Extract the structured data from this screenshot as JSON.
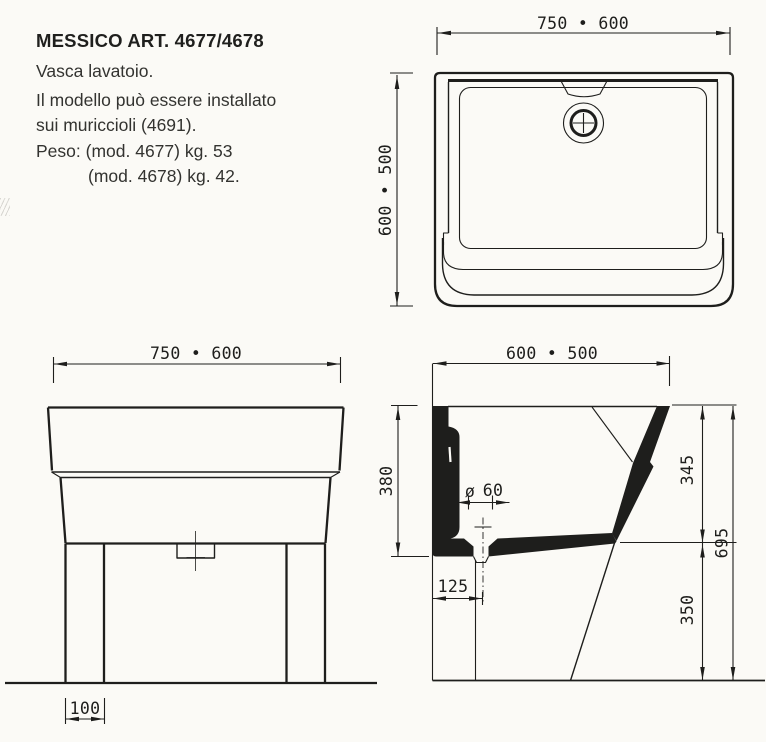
{
  "product": {
    "title": "MESSICO ART. 4677/4678",
    "line1": "Vasca lavatoio.",
    "line2": "Il modello può essere installato",
    "line3": "sui muriccioli (4691).",
    "line4": "Peso: (mod. 4677) kg. 53",
    "line5": "(mod. 4678) kg. 42."
  },
  "dimensions": {
    "top_view": {
      "width": "750 • 600",
      "depth": "600 • 500"
    },
    "front_view": {
      "width": "750 • 600",
      "leg": "100"
    },
    "section_view": {
      "width": "600 • 500",
      "basin_depth": "380",
      "drain_symbol": "ø",
      "drain_diameter": "60",
      "drain_offset": "125",
      "rim_to_outlet": "345",
      "total_height": "695",
      "outlet_to_floor": "350"
    }
  },
  "colors": {
    "ink": "#1e1e1c",
    "paper": "#fbfaf6"
  }
}
